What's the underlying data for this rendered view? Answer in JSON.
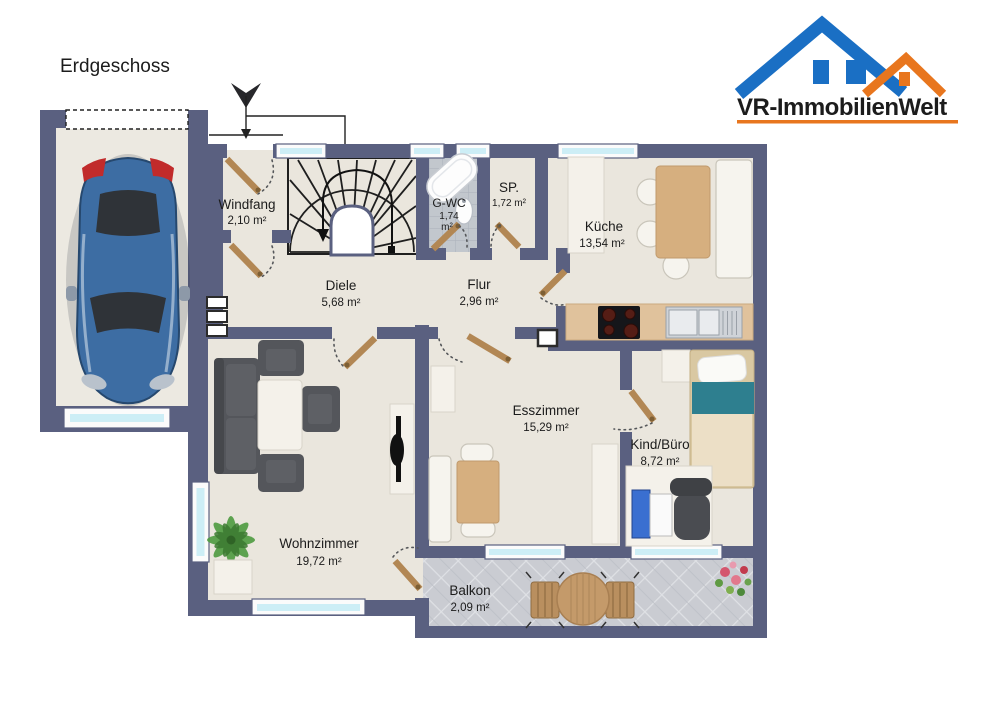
{
  "page": {
    "floor_label": "Erdgeschoss"
  },
  "logo": {
    "brand": "VR-ImmobilienWelt"
  },
  "rooms": {
    "windfang": {
      "name": "Windfang",
      "area": "2,10 m²"
    },
    "diele": {
      "name": "Diele",
      "area": "5,68 m²"
    },
    "gwc": {
      "name": "G-WC",
      "area_line1": "1,74",
      "area_line2": "m²"
    },
    "sp": {
      "name": "SP.",
      "area": "1,72 m²"
    },
    "kueche": {
      "name": "Küche",
      "area": "13,54 m²"
    },
    "flur": {
      "name": "Flur",
      "area": "2,96 m²"
    },
    "esszimmer": {
      "name": "Esszimmer",
      "area": "15,29 m²"
    },
    "kind_buero": {
      "name": "Kind/Büro",
      "area": "8,72 m²"
    },
    "wohnzimmer": {
      "name": "Wohnzimmer",
      "area": "19,72 m²"
    },
    "balkon": {
      "name": "Balkon",
      "area": "2,09 m²"
    }
  },
  "colors": {
    "wall": "#5a6080",
    "floor": "#eae6dd",
    "garage_floor": "#ece9e1",
    "bath_tile": "#c2c7cd",
    "balcony_tile": "#caccd2",
    "window_glass": "#cdeef6",
    "door_wood": "#b28754",
    "counter": "#e0c29c",
    "table_wood": "#d6af7f",
    "sofa": "#54565b",
    "bed_teal": "#2e7f8f",
    "car_blue": "#3d6da3",
    "plant_green": "#4e9b40",
    "logo_blue": "#1a6fc4",
    "logo_orange": "#e8761e",
    "logo_text": "#17386e"
  }
}
